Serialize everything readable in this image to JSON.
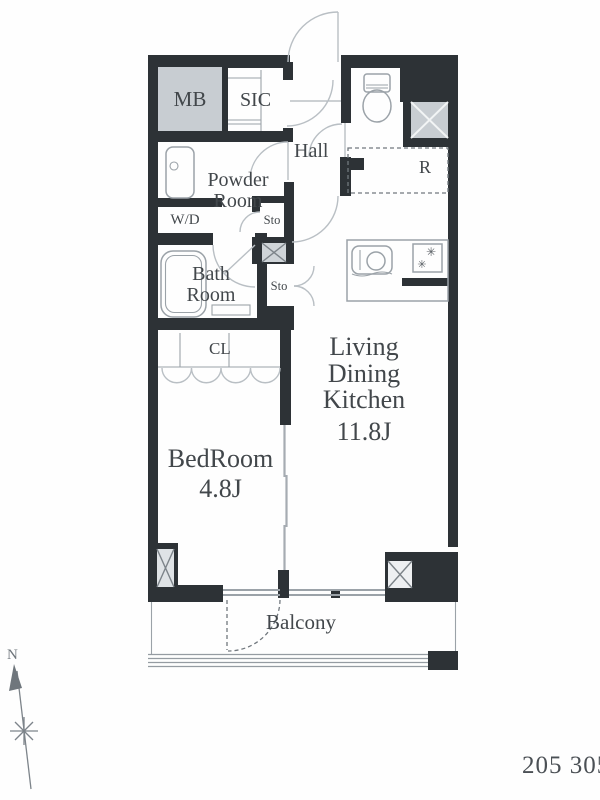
{
  "floor_plan": {
    "rooms": {
      "meter_box": "MB",
      "shoe_closet": "SIC",
      "hall": "Hall",
      "powder_room": [
        "Powder",
        "Room"
      ],
      "washer_dryer": "W/D",
      "bath_room": [
        "Bath",
        "Room"
      ],
      "storage_upper": "Sto",
      "storage_lower": "Sto",
      "closet": "CL",
      "refrigerator_space": "R",
      "living_dining_kitchen": [
        "Living",
        "Dining",
        "Kitchen"
      ],
      "living_dining_kitchen_size": "11.8J",
      "bedroom": "BedRoom",
      "bedroom_size": "4.8J",
      "balcony": "Balcony"
    },
    "compass": {
      "north": "N"
    },
    "footer": {
      "unit_numbers": "205 305"
    },
    "symbols": {
      "stove_burner": "✳"
    },
    "colors": {
      "wall": "#2d3236",
      "fill_gray": "#c8cdd2",
      "fill_gray_light": "#dfe3e6",
      "line_gray": "#9ba2a8",
      "arc_gray": "#b9bfc4",
      "text": "#42474b"
    }
  }
}
